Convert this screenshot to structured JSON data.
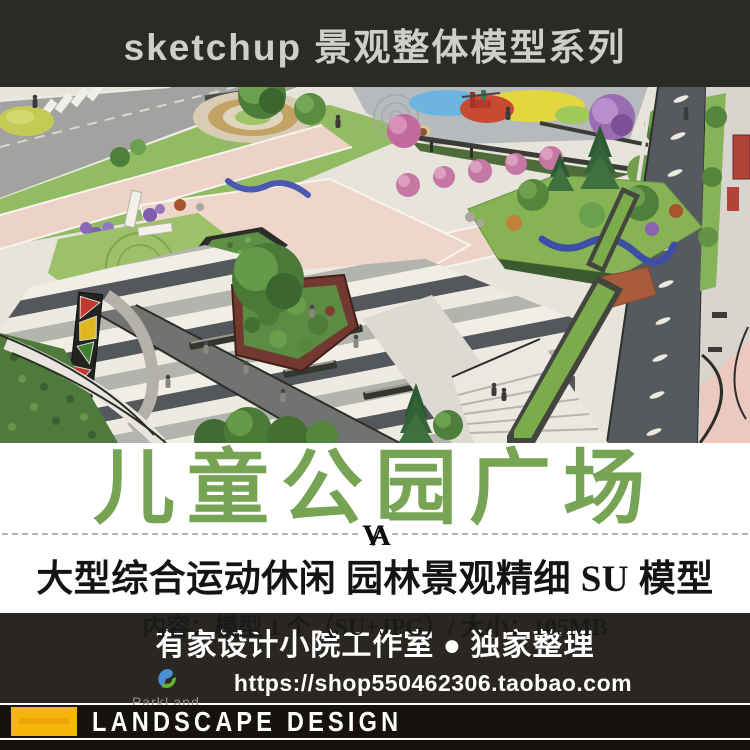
{
  "header": {
    "title": "sketchup 景观整体模型系列"
  },
  "hero": {
    "palette": {
      "plaza_base": "#e7e4dc",
      "lawn_green": "#93bb63",
      "pink_path": "#ecd2c7",
      "road_gray": "#56595d",
      "stripe_dark": "#54575c",
      "playground_red": "#c74a31",
      "playground_yellow": "#e4d63e",
      "playground_blue": "#6db5e1",
      "sculpture_blue": "#3d4fa5",
      "totem_red": "#c1392d",
      "totem_yellow": "#e0b621"
    }
  },
  "title_block": {
    "main_title": "儿童公园广场",
    "title_color": "#76a454",
    "divider_mark": "VA",
    "subtitle": "大型综合运动休闲 园林景观精细 SU 模型",
    "content_line": "内容：模型 1 个（SU+JPG）/ 大小：105MB"
  },
  "footer": {
    "studio_line": "有家设计小院工作室 ● 独家整理",
    "url": "https://shop550462306.taobao.com",
    "brand": "ParkLand",
    "logo_blue": "#4a8fd3",
    "logo_green": "#62b32e"
  },
  "bottom_bar": {
    "label": "LANDSCAPE DESIGN",
    "accent_yellow": "#f6b509"
  }
}
